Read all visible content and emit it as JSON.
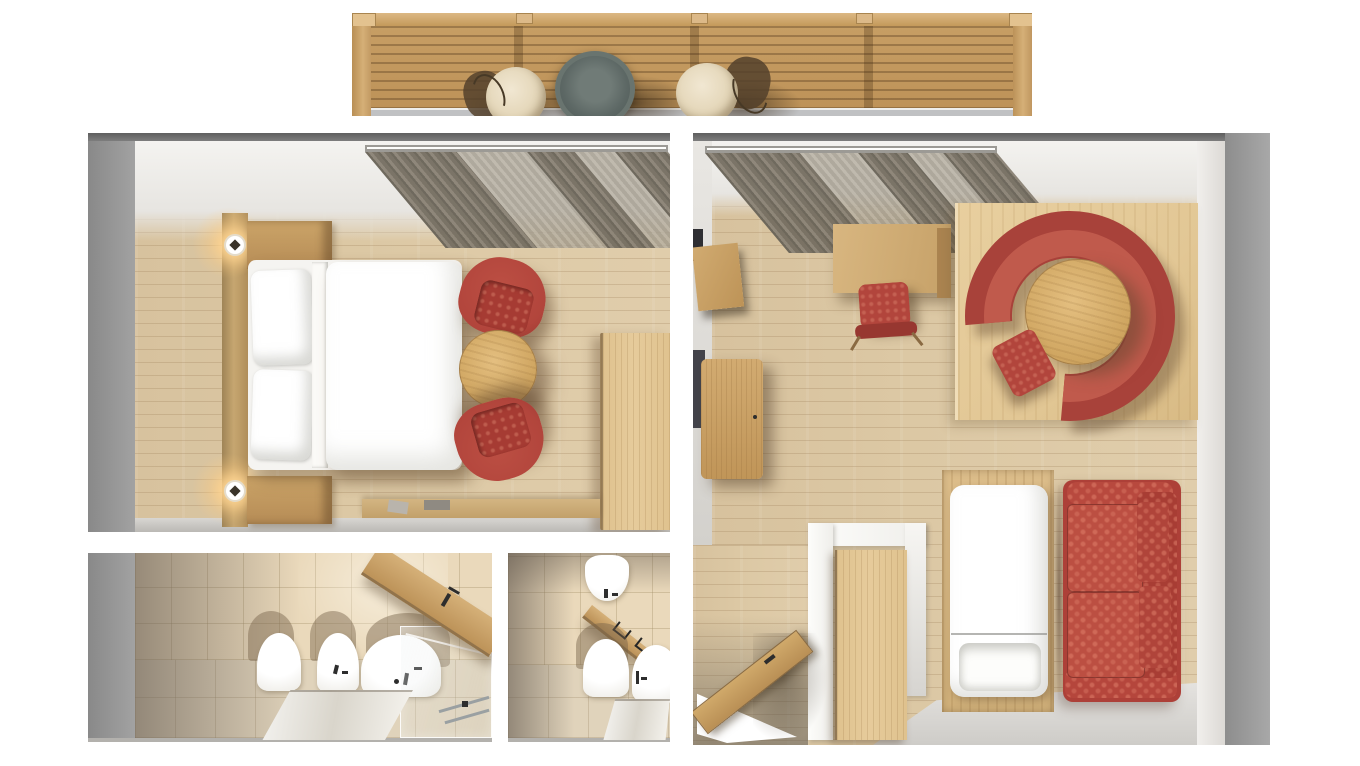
{
  "scene": {
    "type": "3d-floorplan-top-view",
    "description": "Top-down 3D architectural render of a hotel suite: bedroom, living room, two bathrooms and a pergola-covered balcony. No visible text labels in the image.",
    "rooms": [
      "balcony",
      "bedroom",
      "main-bathroom",
      "wc-bathroom",
      "living-room",
      "entrance-hall"
    ]
  },
  "palette": {
    "bg": "#ffffff",
    "wall_outer": "#959595",
    "wall_outer_dark": "#686868",
    "wall_inner": "#efeeec",
    "floor_wood": "#dcc8a4",
    "platform_wood": "#e2c795",
    "furniture_wood": "#c9a268",
    "wardrobe_wood": "#e6cb9b",
    "pergola_wood": "#c59d63",
    "balcony_tile": "#e8d0a6",
    "tile_wall": "#ead9bb",
    "tile_floor": "#e0d3bb",
    "curtain_dark": "#6f685c",
    "curtain_light": "#aaa294",
    "red_main": "#b2453c",
    "red_seat": "#c05a4c",
    "red_dark": "#973730",
    "white_fabric": "#ffffff",
    "shadow_brown": "#5b432c",
    "lamp_glow": "#ffd9a0"
  },
  "balcony": {
    "furniture": [
      "pergola-slatted-roof",
      "round-metal-table",
      "wicker-chair-left",
      "wicker-chair-right",
      "tiled-floor"
    ]
  },
  "bedroom": {
    "furniture": [
      "double-bed-white",
      "pillow x2",
      "headboard-panel",
      "wall-lamp x2",
      "nightstand x2",
      "red-armchair x2",
      "round-wood-table",
      "wardrobe",
      "gray-curtains",
      "vanity-shelf"
    ]
  },
  "main_bathroom": {
    "furniture": [
      "toilet",
      "bidet",
      "bathtub",
      "glass-shower-screen",
      "wood-vanity-counter",
      "floor-mirror-reflection",
      "faucets"
    ]
  },
  "wc_bathroom": {
    "furniture": [
      "wall-sink",
      "towel-rail",
      "toilet",
      "side-fixture",
      "floor-mirror-reflection"
    ]
  },
  "living_room": {
    "furniture": [
      "gray-curtains",
      "wood-desk",
      "red-desk-chair",
      "curved-red-sofa",
      "round-wood-table",
      "red-side-chair",
      "wood-platform",
      "sideboard",
      "wall-cabinet",
      "white-daybed",
      "red-damask-sofa",
      "wardrobe-closet",
      "open-entry-door",
      "white-partition-wall"
    ]
  }
}
